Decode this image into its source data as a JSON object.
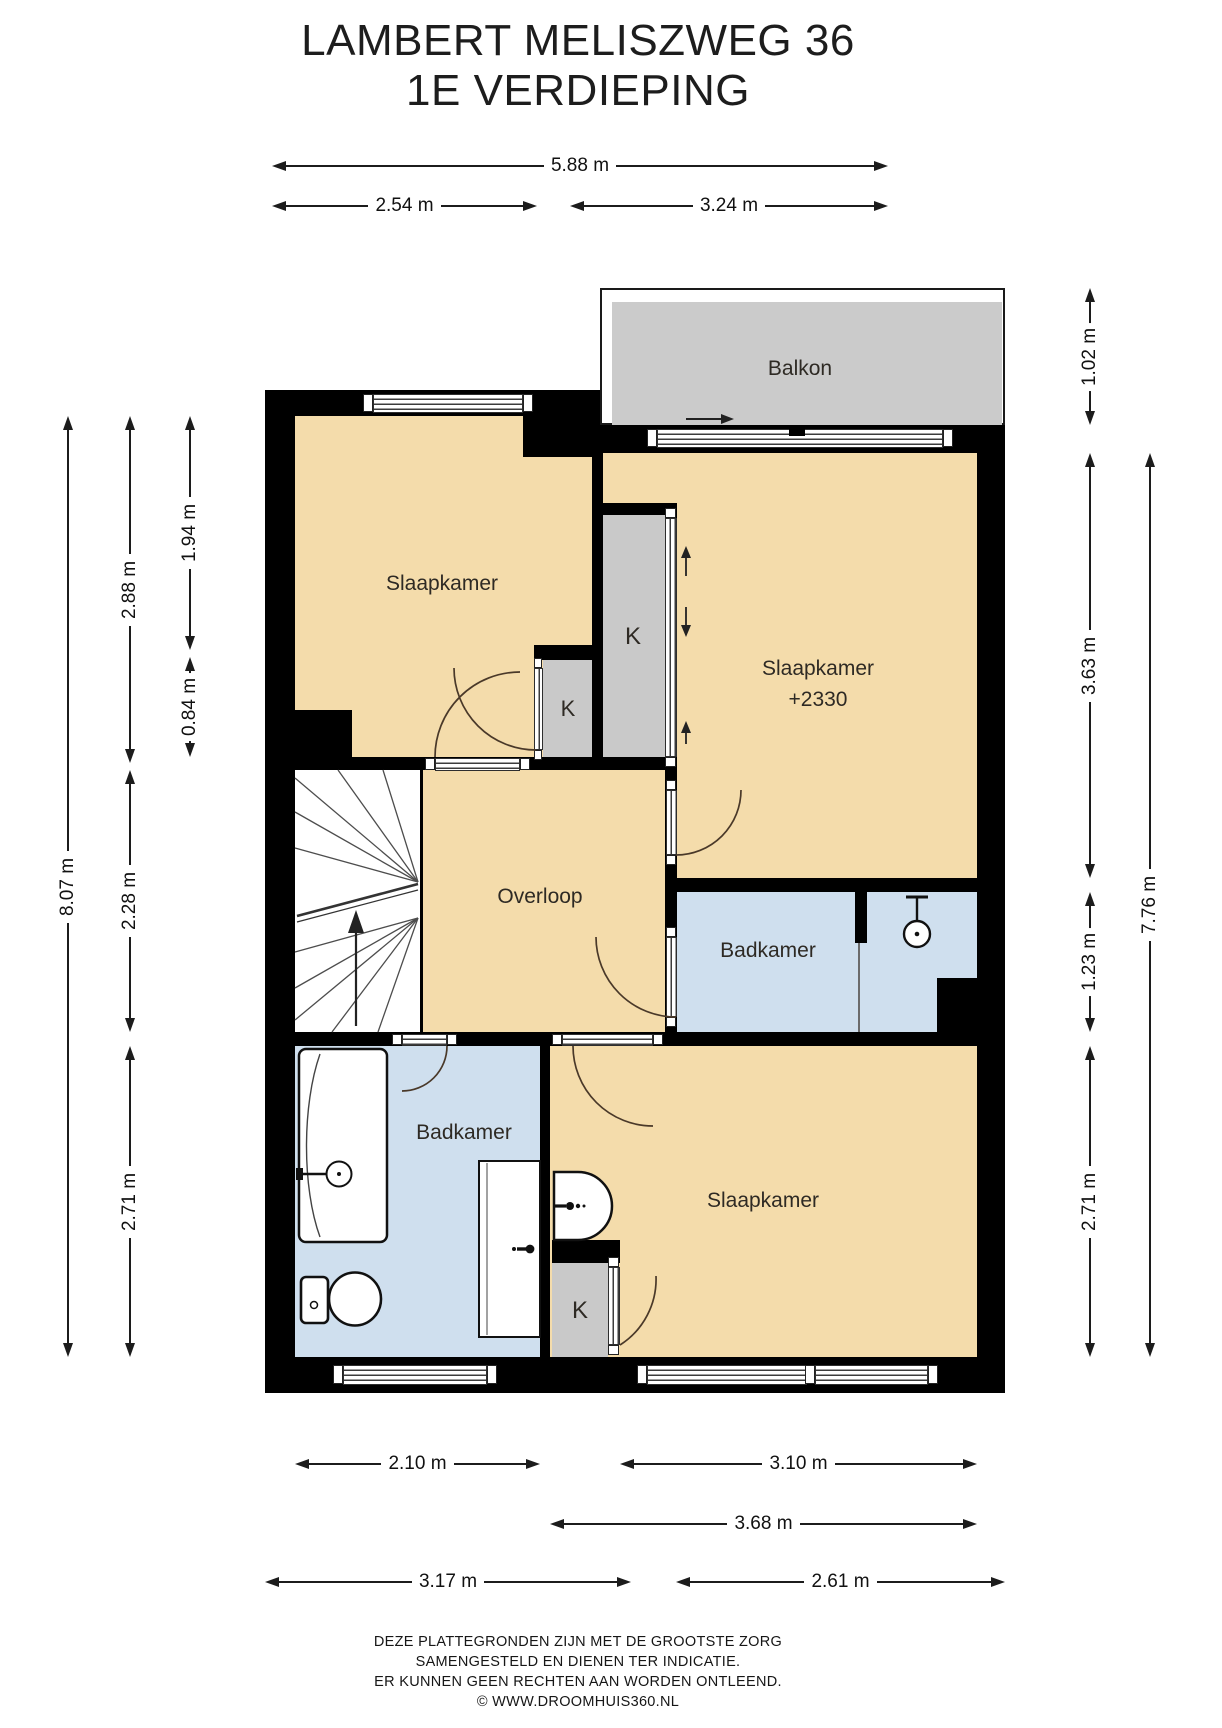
{
  "title": {
    "line1": "LAMBERT MELISZWEG 36",
    "line2": "1E VERDIEPING"
  },
  "colors": {
    "room": "#f4dcab",
    "bath": "#cfdfee",
    "closet": "#c9c9c9",
    "balcony": "#cbcbcb",
    "wall": "#000000"
  },
  "rooms": {
    "balcony": {
      "label": "Balkon"
    },
    "bedroom_top_left": {
      "label": "Slaapkamer"
    },
    "bedroom_top_right": {
      "label": "Slaapkamer",
      "height_note": "+2330"
    },
    "landing": {
      "label": "Overloop"
    },
    "bathroom_right": {
      "label": "Badkamer"
    },
    "bathroom_left": {
      "label": "Badkamer"
    },
    "bedroom_bottom": {
      "label": "Slaapkamer"
    },
    "closet_tall": {
      "label": "K"
    },
    "closet_small": {
      "label": "K"
    },
    "closet_bottom": {
      "label": "K"
    }
  },
  "dimensions": {
    "top": [
      {
        "label": "5.88 m"
      },
      {
        "label": "2.54 m"
      },
      {
        "label": "3.24 m"
      }
    ],
    "left": [
      {
        "label": "8.07 m"
      },
      {
        "label": "2.88 m"
      },
      {
        "label": "2.28 m"
      },
      {
        "label": "2.71 m"
      },
      {
        "label": "1.94 m"
      },
      {
        "label": "0.84 m"
      }
    ],
    "right": [
      {
        "label": "1.02 m"
      },
      {
        "label": "3.63 m"
      },
      {
        "label": "1.23 m"
      },
      {
        "label": "2.71 m"
      },
      {
        "label": "7.76 m"
      }
    ],
    "bottom": [
      {
        "label": "2.10 m"
      },
      {
        "label": "3.10 m"
      },
      {
        "label": "3.68 m"
      },
      {
        "label": "3.17 m"
      },
      {
        "label": "2.61 m"
      }
    ]
  },
  "footer": {
    "lines": [
      "DEZE PLATTEGRONDEN ZIJN MET DE GROOTSTE ZORG",
      "SAMENGESTELD EN DIENEN TER INDICATIE.",
      "ER KUNNEN GEEN RECHTEN AAN WORDEN ONTLEEND.",
      "© WWW.DROOMHUIS360.NL"
    ]
  }
}
